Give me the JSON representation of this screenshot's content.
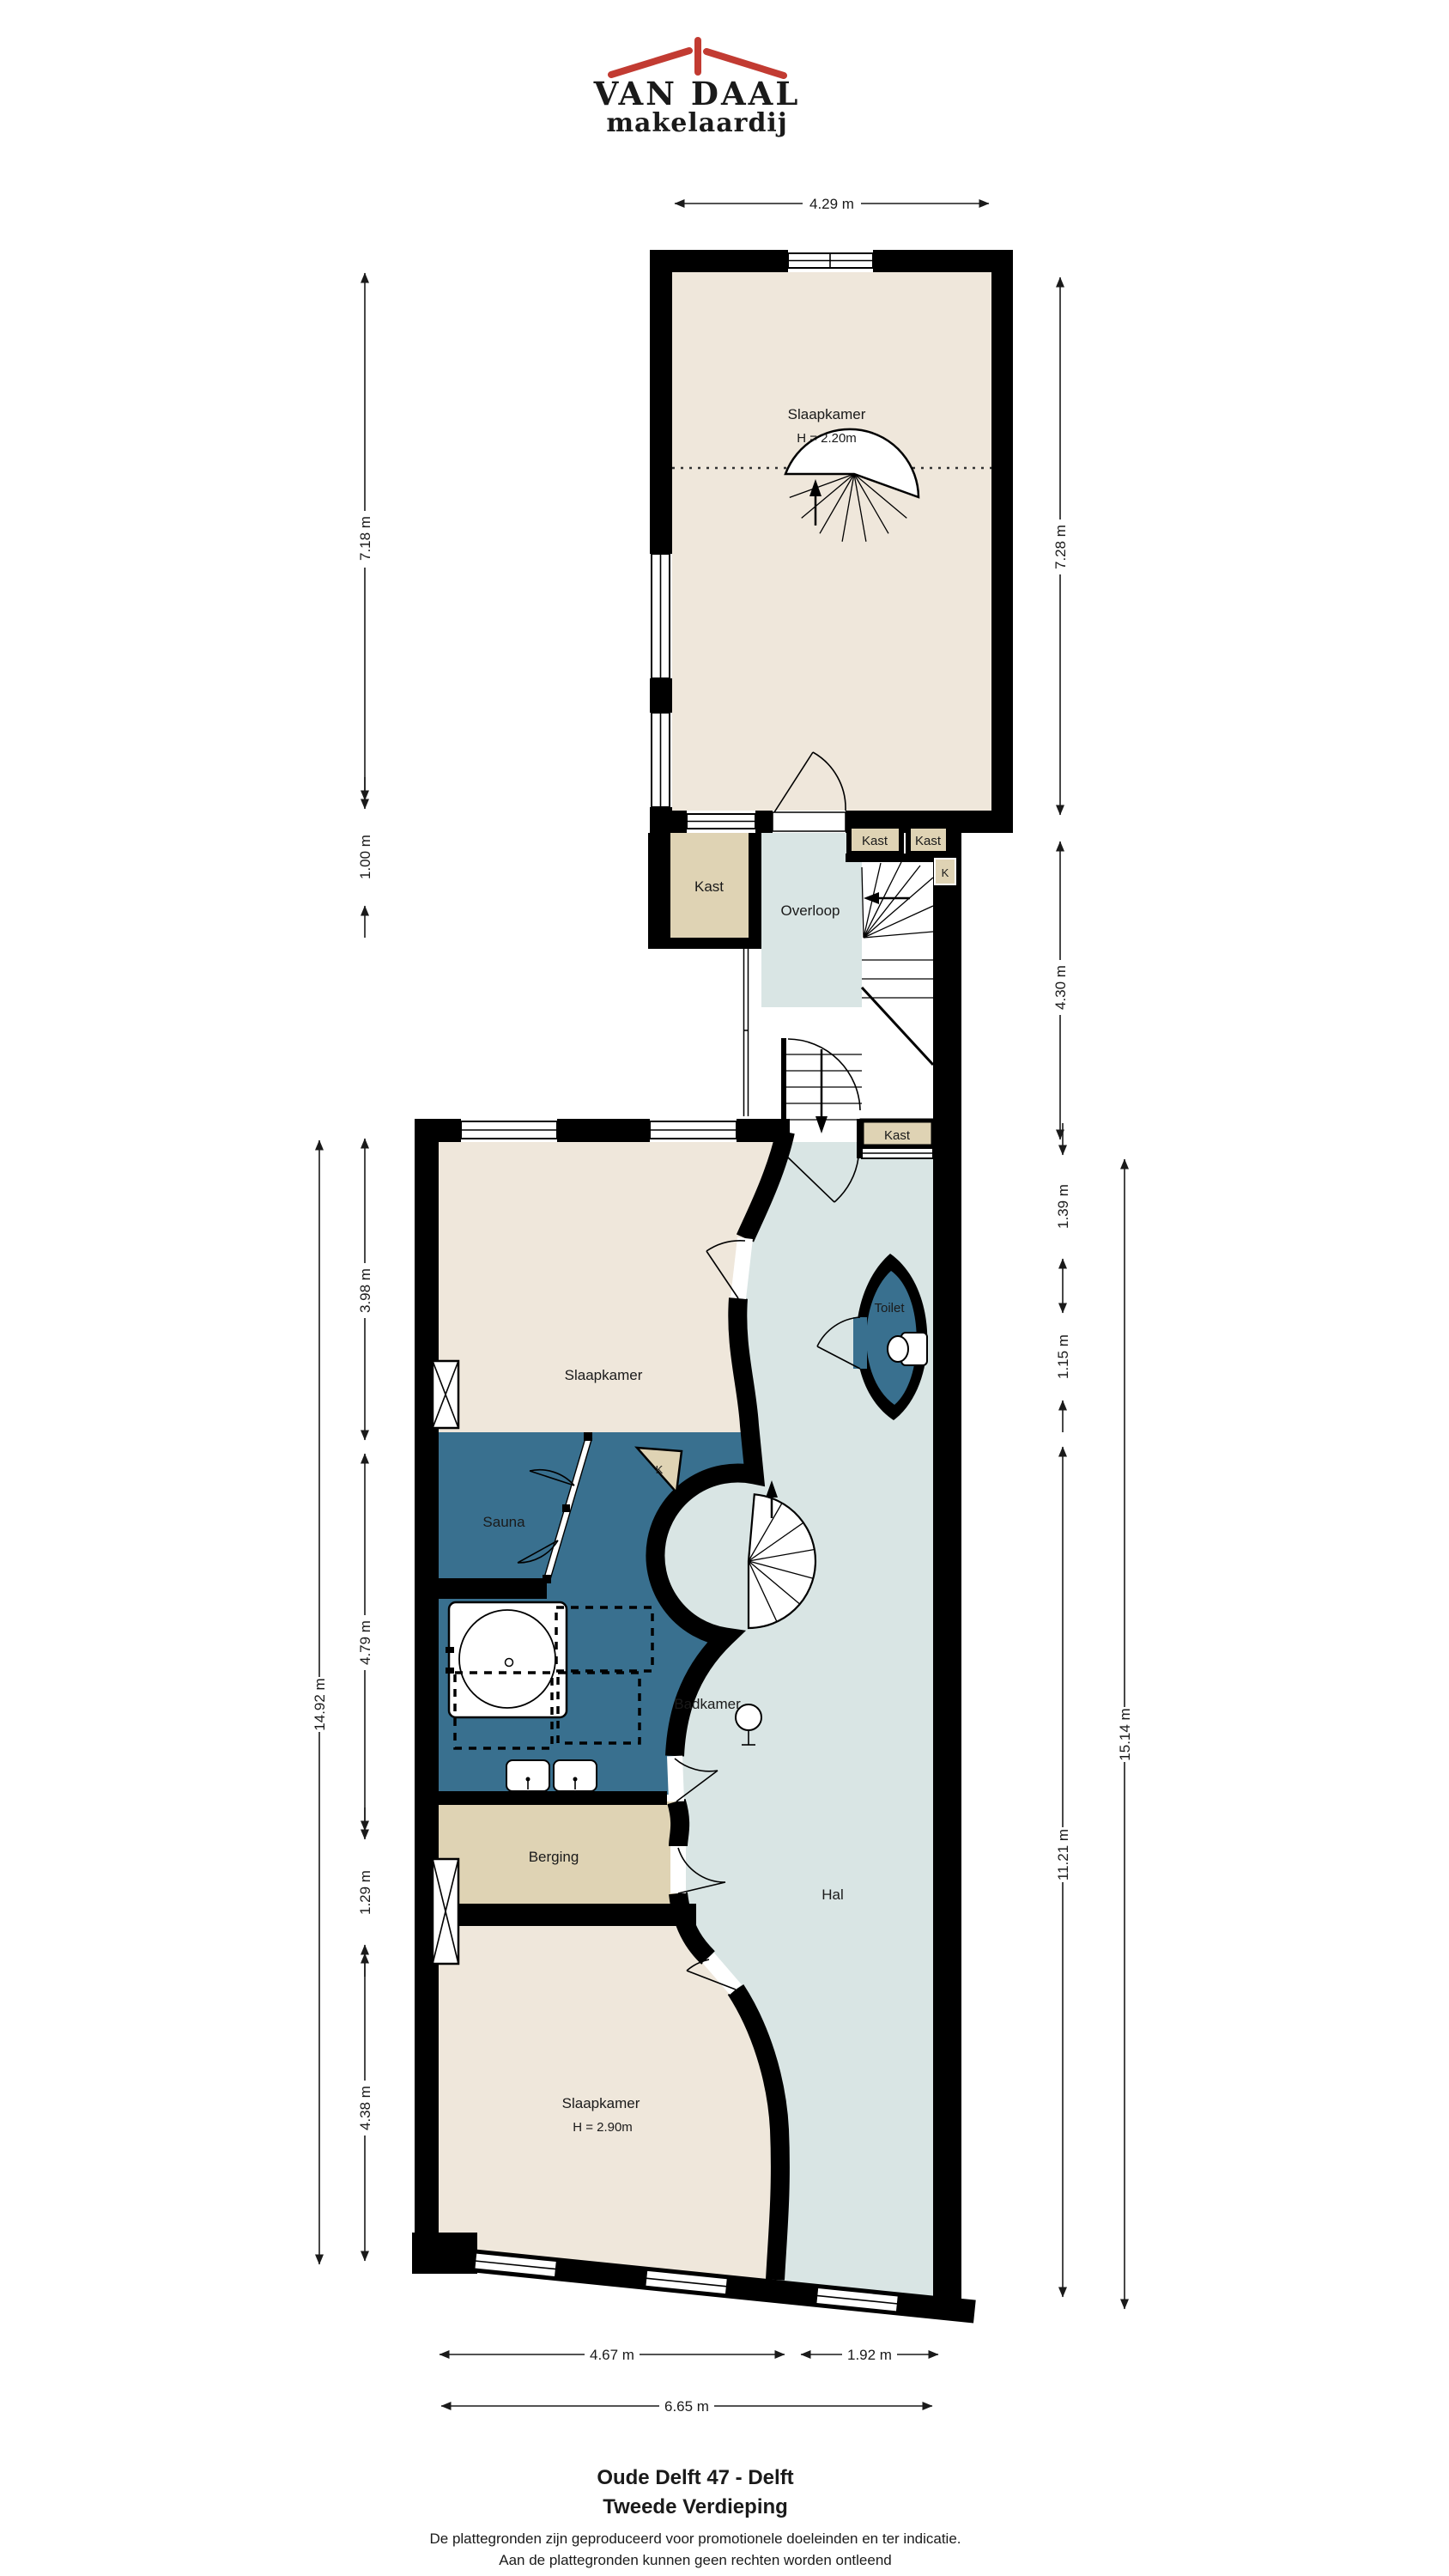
{
  "logo": {
    "name": "VAN DAAL",
    "subtitle": "makelaardij",
    "brand_blue": "#2E4D96",
    "brand_red": "#C23B32"
  },
  "rooms": {
    "slaapkamer_top": {
      "label": "Slaapkamer",
      "height": "H = 2.20m"
    },
    "kast_mid": {
      "label": "Kast"
    },
    "overloop": {
      "label": "Overloop"
    },
    "kast_small_1": {
      "label": "Kast"
    },
    "kast_small_2": {
      "label": "Kast"
    },
    "k_niche": {
      "label": "K"
    },
    "kast_lower": {
      "label": "Kast"
    },
    "slaapkamer_mid": {
      "label": "Slaapkamer"
    },
    "toilet": {
      "label": "Toilet"
    },
    "sauna": {
      "label": "Sauna"
    },
    "k_closet": {
      "label": "K"
    },
    "badkamer": {
      "label": "Badkamer"
    },
    "berging": {
      "label": "Berging"
    },
    "hal": {
      "label": "Hal"
    },
    "slaapkamer_bottom": {
      "label": "Slaapkamer",
      "height": "H = 2.90m"
    }
  },
  "dimensions": {
    "top_width": "4.29 m",
    "left_upper": "7.18 m",
    "left_kast": "1.00 m",
    "right_upper": "7.28 m",
    "right_stairs": "4.30 m",
    "left_total": "14.92 m",
    "left_seg1": "3.98 m",
    "left_seg2": "4.79 m",
    "left_seg3": "1.29 m",
    "left_seg4": "4.38 m",
    "right_seg1": "1.39 m",
    "right_seg2": "1.15 m",
    "right_seg3": "11.21 m",
    "right_total": "15.14 m",
    "bottom_left": "4.67 m",
    "bottom_right": "1.92 m",
    "bottom_total": "6.65 m"
  },
  "footer": {
    "title_line1": "Oude Delft 47 - Delft",
    "title_line2": "Tweede Verdieping",
    "disclaimer_line1": "De plattegronden zijn geproduceerd voor promotionele doeleinden en ter indicatie.",
    "disclaimer_line2": "Aan de plattegronden kunnen geen rechten worden ontleend"
  },
  "colors": {
    "wall": "#000000",
    "room_cream": "#EFE7DB",
    "room_tan": "#DFD3B4",
    "room_lightblue": "#D9E5E4",
    "room_darkblue": "#39708F"
  }
}
